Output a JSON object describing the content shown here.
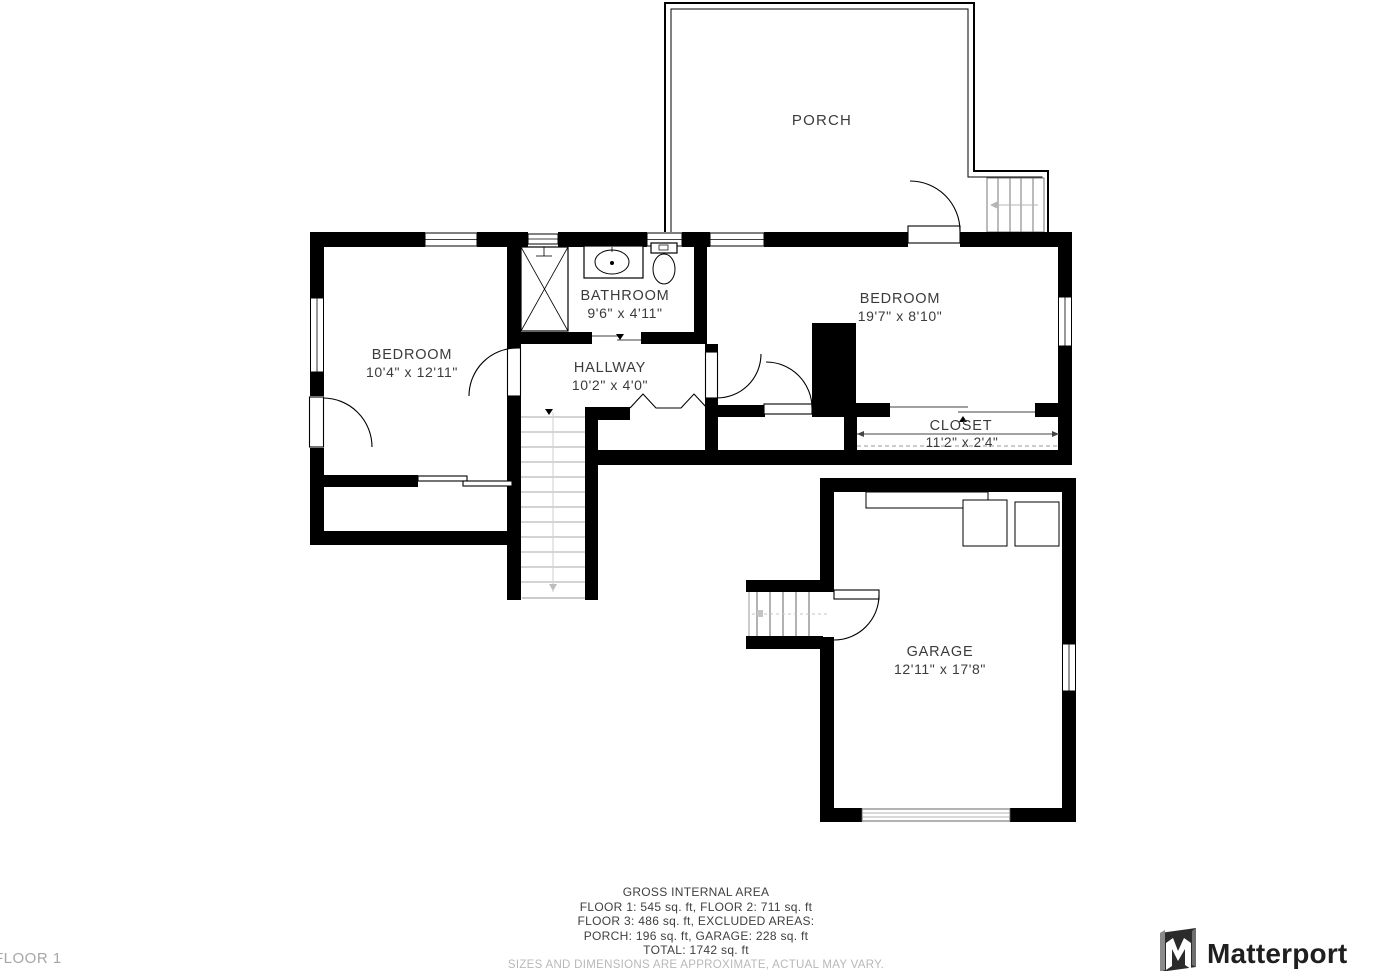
{
  "floor_indicator": "FLOOR 1",
  "brand": {
    "name": "Matterport"
  },
  "rooms": {
    "porch": {
      "name": "PORCH"
    },
    "bedroom_left": {
      "name": "BEDROOM",
      "dims": "10'4\" x 12'11\""
    },
    "bathroom": {
      "name": "BATHROOM",
      "dims": "9'6\" x 4'11\""
    },
    "hallway": {
      "name": "HALLWAY",
      "dims": "10'2\" x 4'0\""
    },
    "bedroom_right": {
      "name": "BEDROOM",
      "dims": "19'7\" x 8'10\""
    },
    "closet": {
      "name": "CLOSET",
      "dims": "11'2\" x 2'4\""
    },
    "garage": {
      "name": "GARAGE",
      "dims": "12'11\" x 17'8\""
    }
  },
  "footer": {
    "title": "GROSS INTERNAL AREA",
    "line1": "FLOOR 1: 545 sq. ft, FLOOR 2: 711 sq. ft",
    "line2": "FLOOR 3: 486 sq. ft, EXCLUDED AREAS:",
    "line3": "PORCH: 196 sq. ft, GARAGE: 228 sq. ft",
    "line4": "TOTAL: 1742 sq. ft",
    "disclaimer": "SIZES AND DIMENSIONS ARE APPROXIMATE, ACTUAL MAY VARY."
  },
  "colors": {
    "wall": "#000000",
    "label": "#3b3b3b",
    "muted": "#a6a6a6",
    "disclaimer": "#b8b8b8",
    "logo": "#1f1f1f",
    "background": "#ffffff"
  }
}
